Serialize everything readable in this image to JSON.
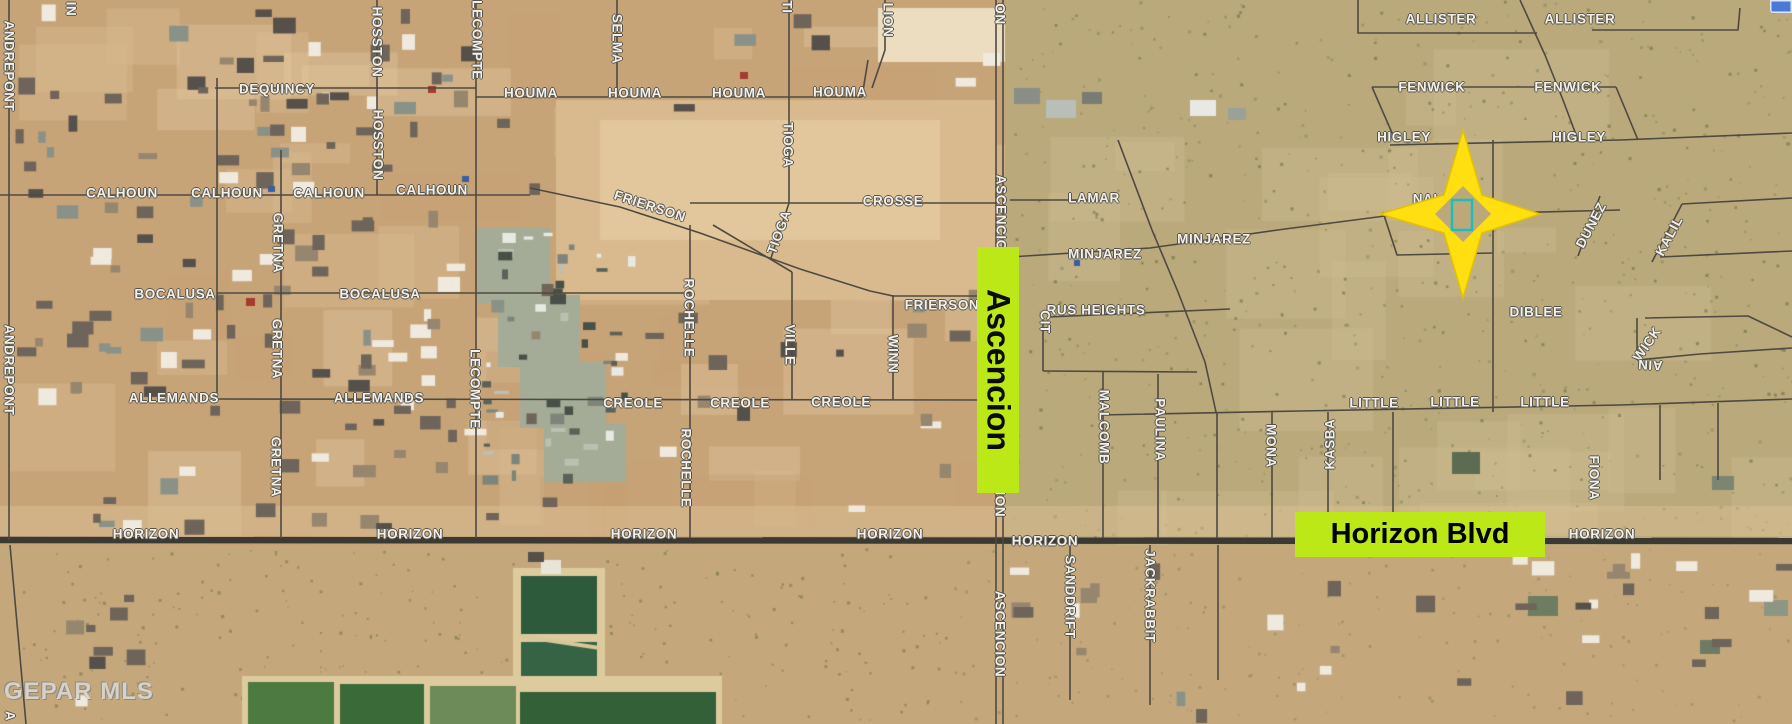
{
  "watermark": "GEPAR MLS",
  "highlights": {
    "ascencion": {
      "label": "Ascencion",
      "color": "#bce817"
    },
    "horizon_blvd": {
      "label": "Horizon Blvd",
      "color": "#bce817"
    }
  },
  "marker": {
    "description": "four-point-star-over-parcel",
    "star_color": "#ffdf0f",
    "star_edge_color": "#e3c100",
    "parcel_outline_color": "#1fbdb8"
  },
  "map_label_color": "#f2f0ea",
  "street_labels": [
    {
      "t": "DEQUINCY",
      "x": 277,
      "y": 89
    },
    {
      "t": "CALHOUN",
      "x": 122,
      "y": 193
    },
    {
      "t": "CALHOUN",
      "x": 227,
      "y": 193
    },
    {
      "t": "CALHOUN",
      "x": 329,
      "y": 193
    },
    {
      "t": "CALHOUN",
      "x": 432,
      "y": 190
    },
    {
      "t": "HOUMA",
      "x": 531,
      "y": 93
    },
    {
      "t": "HOUMA",
      "x": 635,
      "y": 93
    },
    {
      "t": "HOUMA",
      "x": 739,
      "y": 93
    },
    {
      "t": "HOUMA",
      "x": 840,
      "y": 92
    },
    {
      "t": "BOCALUSA",
      "x": 175,
      "y": 294
    },
    {
      "t": "BOCALUSA",
      "x": 380,
      "y": 294
    },
    {
      "t": "ALLEMANDS",
      "x": 174,
      "y": 398
    },
    {
      "t": "ALLEMANDS",
      "x": 379,
      "y": 398
    },
    {
      "t": "CREOLE",
      "x": 633,
      "y": 403
    },
    {
      "t": "CREOLE",
      "x": 740,
      "y": 403
    },
    {
      "t": "CREOLE",
      "x": 841,
      "y": 402
    },
    {
      "t": "CROSSE",
      "x": 893,
      "y": 201
    },
    {
      "t": "FRIERSON",
      "x": 650,
      "y": 206,
      "r": 18
    },
    {
      "t": "FRIERSON",
      "x": 942,
      "y": 305
    },
    {
      "t": "LAMAR",
      "x": 1094,
      "y": 198
    },
    {
      "t": "MINJAREZ",
      "x": 1105,
      "y": 254
    },
    {
      "t": "MINJAREZ",
      "x": 1214,
      "y": 239
    },
    {
      "t": "RUS HEIGHTS",
      "x": 1096,
      "y": 310
    },
    {
      "t": "CIT",
      "x": 1045,
      "y": 322,
      "r": 90
    },
    {
      "t": "DIBLEE",
      "x": 1536,
      "y": 312
    },
    {
      "t": "LITTLE",
      "x": 1374,
      "y": 403
    },
    {
      "t": "LITTLE",
      "x": 1455,
      "y": 402
    },
    {
      "t": "LITTLE",
      "x": 1545,
      "y": 402
    },
    {
      "t": "NALANI",
      "x": 1440,
      "y": 199
    },
    {
      "t": "ALLISTER",
      "x": 1441,
      "y": 19
    },
    {
      "t": "ALLISTER",
      "x": 1580,
      "y": 19
    },
    {
      "t": "FENWICK",
      "x": 1432,
      "y": 87
    },
    {
      "t": "FENWICK",
      "x": 1568,
      "y": 87
    },
    {
      "t": "HIGLEY",
      "x": 1404,
      "y": 137
    },
    {
      "t": "HIGLEY",
      "x": 1579,
      "y": 137
    },
    {
      "t": "HORIZON",
      "x": 146,
      "y": 534
    },
    {
      "t": "HORIZON",
      "x": 410,
      "y": 534
    },
    {
      "t": "HORIZON",
      "x": 644,
      "y": 534
    },
    {
      "t": "HORIZON",
      "x": 890,
      "y": 534
    },
    {
      "t": "HORIZON",
      "x": 1045,
      "y": 541
    },
    {
      "t": "HORIZON",
      "x": 1602,
      "y": 534
    },
    {
      "t": "ANDREPONT",
      "x": 9,
      "y": 66,
      "r": 90
    },
    {
      "t": "ANDREPONT",
      "x": 9,
      "y": 370,
      "r": 90
    },
    {
      "t": "IN",
      "x": 71,
      "y": 9,
      "r": 90
    },
    {
      "t": "HOSSTON",
      "x": 377,
      "y": 42,
      "r": 90
    },
    {
      "t": "HOSSTON",
      "x": 378,
      "y": 145,
      "r": 90
    },
    {
      "t": "GRETNA",
      "x": 278,
      "y": 243,
      "r": 90
    },
    {
      "t": "GRETNA",
      "x": 277,
      "y": 349,
      "r": 90
    },
    {
      "t": "GRETNA",
      "x": 276,
      "y": 467,
      "r": 90
    },
    {
      "t": "LECOMPTE",
      "x": 477,
      "y": 40,
      "r": 90
    },
    {
      "t": "LECOMPTE",
      "x": 475,
      "y": 389,
      "r": 90
    },
    {
      "t": "SELMA",
      "x": 617,
      "y": 39,
      "r": 90
    },
    {
      "t": "TI",
      "x": 787,
      "y": 7,
      "r": 90
    },
    {
      "t": "TIOGA",
      "x": 788,
      "y": 145,
      "r": 90
    },
    {
      "t": "TIOGA",
      "x": 779,
      "y": 232,
      "r": -70
    },
    {
      "t": "LION",
      "x": 888,
      "y": 20,
      "r": 90
    },
    {
      "t": "ROCHELLE",
      "x": 689,
      "y": 318,
      "r": 90
    },
    {
      "t": "ROCHELLE",
      "x": 686,
      "y": 468,
      "r": 90
    },
    {
      "t": "VILLE",
      "x": 790,
      "y": 345,
      "r": 90
    },
    {
      "t": "WINN",
      "x": 893,
      "y": 354,
      "r": 90
    },
    {
      "t": "ON",
      "x": 1000,
      "y": 14,
      "r": 90
    },
    {
      "t": "ASCENCION",
      "x": 1001,
      "y": 218,
      "r": 90
    },
    {
      "t": "ASCENCION",
      "x": 1000,
      "y": 474,
      "r": 90
    },
    {
      "t": "ASCENCION",
      "x": 1000,
      "y": 634,
      "r": 90
    },
    {
      "t": "MALCOMB",
      "x": 1104,
      "y": 427,
      "r": 90
    },
    {
      "t": "PAULINA",
      "x": 1160,
      "y": 430,
      "r": 90
    },
    {
      "t": "MONA",
      "x": 1271,
      "y": 446,
      "r": 90
    },
    {
      "t": "KASBA",
      "x": 1330,
      "y": 444,
      "r": -90
    },
    {
      "t": "FIONA",
      "x": 1594,
      "y": 478,
      "r": 90
    },
    {
      "t": "SANDDRIFT",
      "x": 1070,
      "y": 597,
      "r": 90
    },
    {
      "t": "JACKRABBIT",
      "x": 1150,
      "y": 596,
      "r": 90
    },
    {
      "t": "DUNEZ",
      "x": 1591,
      "y": 225,
      "r": -62
    },
    {
      "t": "KALIL",
      "x": 1669,
      "y": 236,
      "r": -62
    },
    {
      "t": "WICK",
      "x": 1647,
      "y": 344,
      "r": -55
    },
    {
      "t": "AIN",
      "x": 1650,
      "y": 365,
      "r": 183
    },
    {
      "t": "A",
      "x": 10,
      "y": 716,
      "r": 90
    }
  ]
}
